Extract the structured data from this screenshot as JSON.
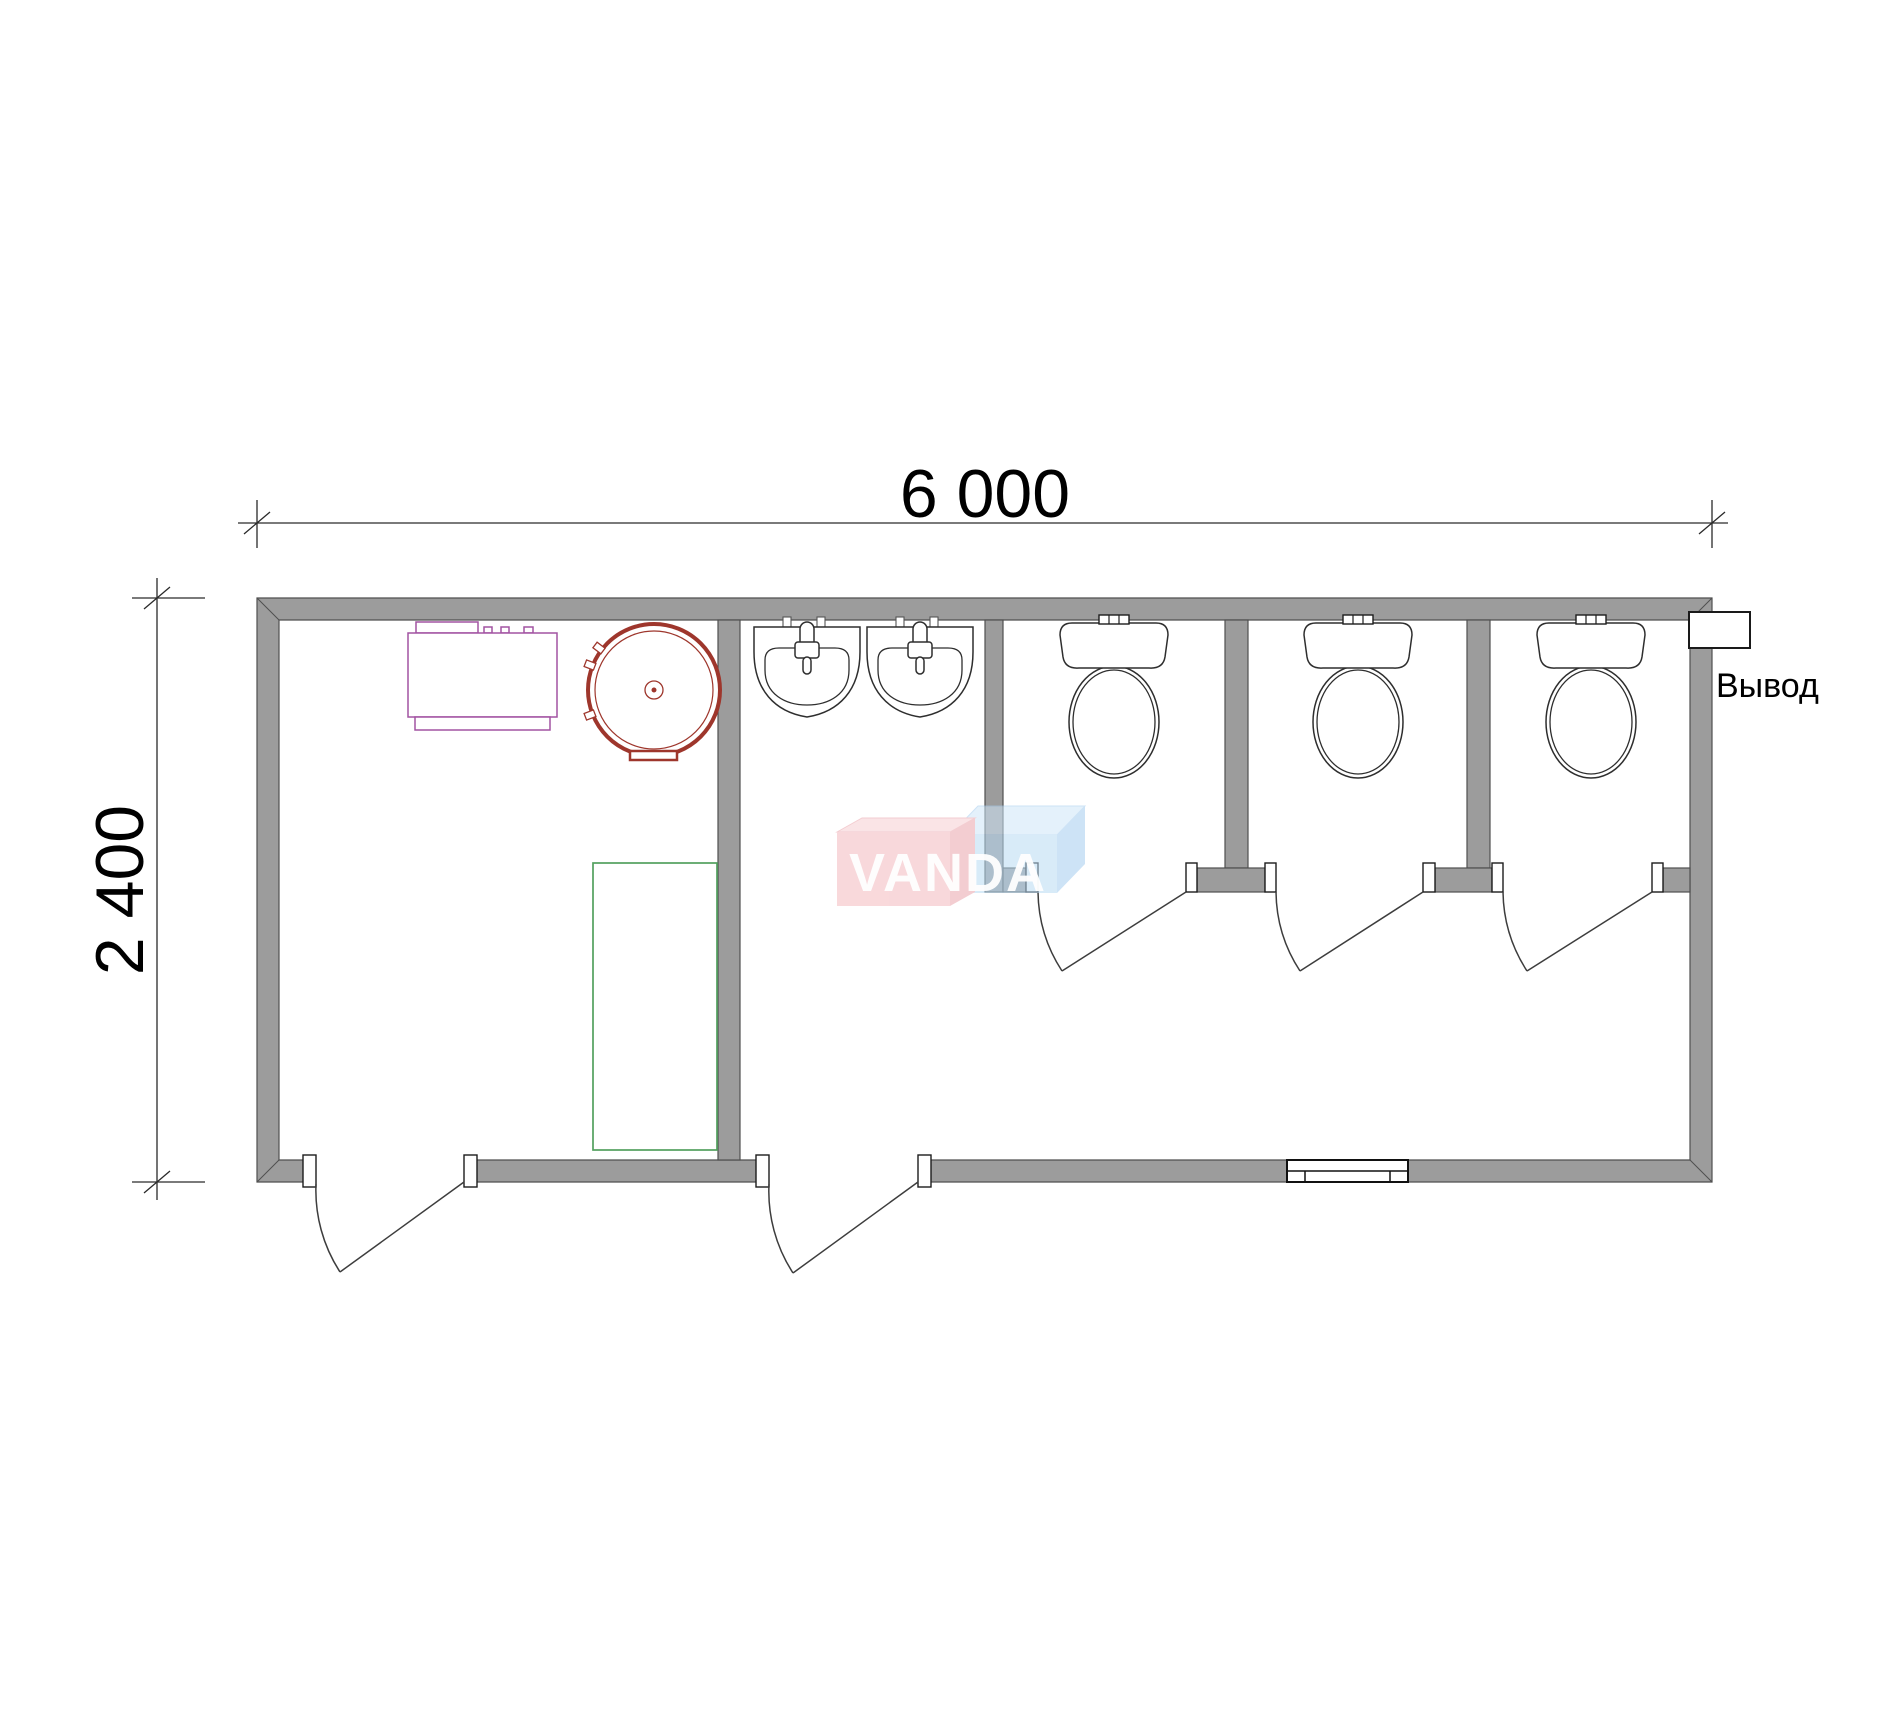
{
  "dimensions": {
    "width_mm": "6 000",
    "height_mm": "2 400"
  },
  "labels": {
    "outlet": "Вывод"
  },
  "watermark": {
    "text": "VANDA"
  },
  "fixtures": {
    "toilets": 3,
    "washbasins": 2,
    "shower_trays": 1,
    "water_heaters": 1,
    "boiler_units": 1,
    "stall_doors": 3,
    "entrance_doors": 2,
    "windows": 1,
    "utility_outlets": 1
  },
  "colors": {
    "wall_fill": "#9c9c9c",
    "wall_stroke": "#4f4f4f",
    "fixture_line": "#2e2e2e",
    "boiler": "#a253a2",
    "heater": "#9e362c",
    "shower": "#53a05e",
    "wm_pink": "#f4b9be",
    "wm_pink_top": "#f7cfd3",
    "wm_pink_side": "#eba6ad",
    "wm_blue": "#badbf4",
    "wm_blue_top": "#cfe6f8",
    "wm_blue_side": "#a6cdef"
  }
}
